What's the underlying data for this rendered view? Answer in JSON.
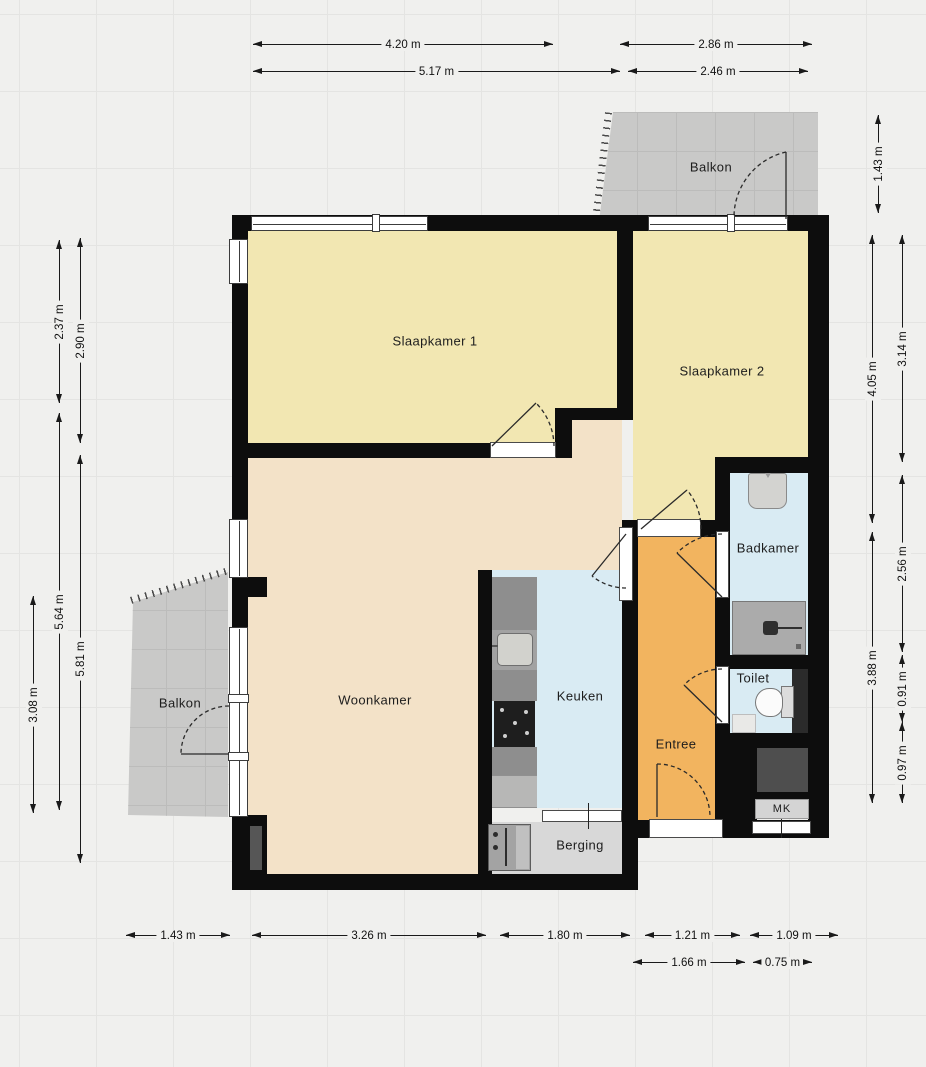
{
  "plan": {
    "type": "floorplan",
    "rooms": {
      "balkon_top": {
        "label": "Balkon"
      },
      "slaapkamer1": {
        "label": "Slaapkamer 1"
      },
      "slaapkamer2": {
        "label": "Slaapkamer 2"
      },
      "woonkamer": {
        "label": "Woonkamer"
      },
      "keuken": {
        "label": "Keuken"
      },
      "badkamer": {
        "label": "Badkamer"
      },
      "toilet": {
        "label": "Toilet"
      },
      "entree": {
        "label": "Entree"
      },
      "berging": {
        "label": "Berging"
      },
      "balkon_left": {
        "label": "Balkon"
      },
      "mk": {
        "label": "MK"
      }
    },
    "dimensions": {
      "top": {
        "r1a": "4.20 m",
        "r1b": "2.86 m",
        "r2a": "5.17 m",
        "r2b": "2.46 m"
      },
      "right": {
        "balkon": "1.43 m",
        "outer1": "4.05 m",
        "inner1": "3.14 m",
        "inner2": "2.56 m",
        "outer2": "3.88 m",
        "inner3": "0.91 m",
        "inner4": "0.97 m"
      },
      "left": {
        "outer1": "3.08 m",
        "mid1": "2.37 m",
        "mid2": "5.64 m",
        "inner1": "2.90 m",
        "inner2": "5.81 m"
      },
      "bottom": {
        "r1a": "1.43 m",
        "r1b": "3.26 m",
        "r1c": "1.80 m",
        "r1d": "1.21 m",
        "r1e": "1.09 m",
        "r2a": "1.66 m",
        "r2b": "0.75 m"
      }
    },
    "colors": {
      "wall": "#0d0d0d",
      "bedroom_floor": "#f2e7b2",
      "living_floor": "#f3e2c8",
      "wet_room_floor": "#d9ebf3",
      "hall_floor": "#f2b45f",
      "storage_floor": "#d8d8d8",
      "balcony_floor": "#c9c9c8",
      "background": "#f0f0ee"
    }
  }
}
